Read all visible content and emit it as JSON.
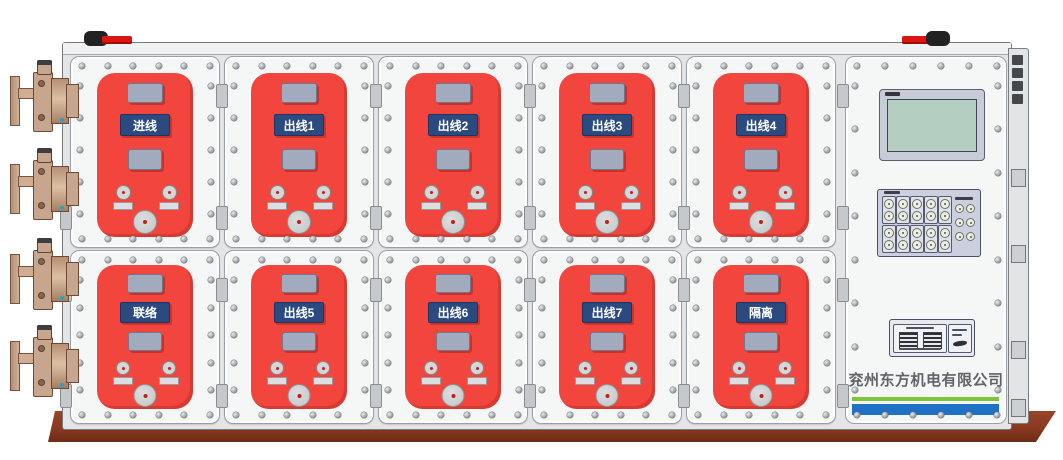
{
  "device": {
    "company_name": "兖州东方机电有限公司",
    "panels": {
      "top_row": [
        "进线",
        "出线1",
        "出线2",
        "出线3",
        "出线4"
      ],
      "bottom_row": [
        "联络",
        "出线5",
        "出线6",
        "出线7",
        "隔离"
      ]
    },
    "colors": {
      "panel_red": "#f2453d",
      "label_navy": "#2b4a80",
      "stripe_green": "#80c33c",
      "stripe_blue": "#1f71c6",
      "base_brown": "#8a3a20",
      "screen_green": "#b4cfc1",
      "flange_tan": "#c8a68e",
      "handle_red": "#dd1510"
    }
  }
}
